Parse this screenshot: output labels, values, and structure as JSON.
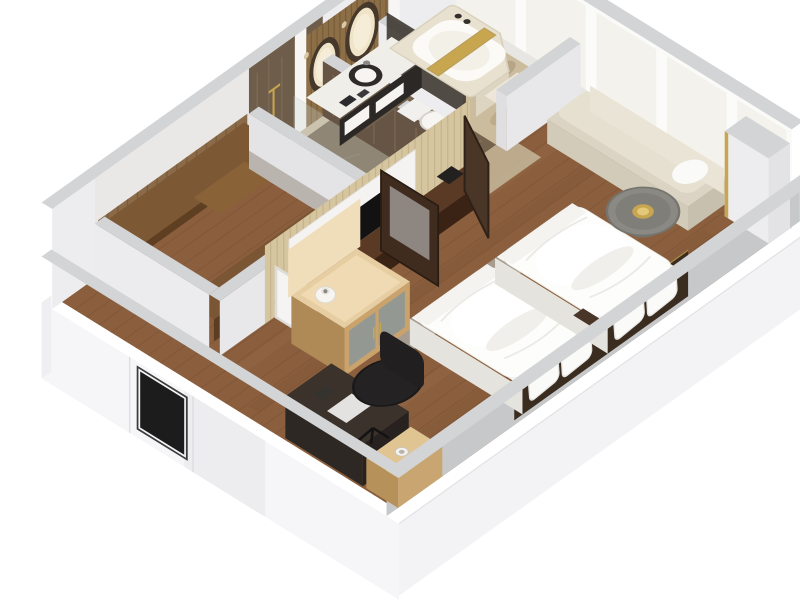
{
  "window": {
    "width": 800,
    "height": 600,
    "background": "#ffffff"
  },
  "scene": {
    "type": "3d-floorplan-cutaway-render",
    "subject": "hotel guest room with twin beds",
    "view": "isometric top-down, rotated, walls cut at height, white background",
    "rooms": [
      {
        "name": "bathroom",
        "floor": "beige marble",
        "objects": [
          "vanity-counter",
          "vessel-sink",
          "oval-mirror-1",
          "oval-mirror-2",
          "gold-slat-wall",
          "bathtub",
          "gold-bath-tray",
          "towels"
        ]
      },
      {
        "name": "shower-room",
        "floor": "dark marble",
        "objects": [
          "shower-bench",
          "glass-screen",
          "shower-fixture"
        ]
      },
      {
        "name": "water-closet",
        "floor": "dark marble",
        "objects": [
          "toilet"
        ]
      },
      {
        "name": "walk-in-closet",
        "floor": "wood",
        "objects": [
          "closet-shelf",
          "hanging-clothes",
          "drawer-unit"
        ]
      },
      {
        "name": "bedroom",
        "floor": "wood planks",
        "objects": [
          "bed-1",
          "bed-2",
          "headboard",
          "mid-nightstand",
          "tv-panel",
          "tv-console",
          "tissue-box",
          "window-daybed",
          "round-table",
          "gold-bowl",
          "desk",
          "desk-chair",
          "low-nightstand",
          "minibar-cabinet",
          "white-vase",
          "gray-runner-rug",
          "open-door-leaf",
          "wardrobe-door-mirror"
        ]
      },
      {
        "name": "entry",
        "objects": [
          "entry-door"
        ]
      }
    ],
    "window_wall": {
      "position": "upper-right",
      "panes": 5,
      "mullions": "white"
    }
  },
  "palette": {
    "background": "#ffffff",
    "wood_floor": "#8b5f3e",
    "wood_plank_line": "#6e4a2c",
    "wood_streak_light": "#a0744e",
    "marble_beige": "#ccbc9e",
    "marble_beige_mottle": "#ae9a76",
    "marble_dark_floor": "#75634e",
    "marble_dark_wall": "#6e5d4a",
    "wall_top": "#d3d4d6",
    "wall_inner": "#ededef",
    "wall_outer": "#f4f4f6",
    "window_glass": "#f4f2ec",
    "bed_white": "#fdfdfb",
    "duvet_shadow": "#e9e8e3",
    "headboard": "#3b2c20",
    "console_wood": "#5a3a24",
    "tv_backing": "#d6c6a0",
    "tv_screen": "#121212",
    "gold_accent": "#c8a54f",
    "gold_slat_wall": "#8d6f47",
    "minibar_wood": "#e7cda2",
    "desk_dark": "#3a322b",
    "chair_black": "#242223",
    "bench_cushion": "#e6e0d1",
    "tub_deck": "#e8e1cf",
    "entry_door": "#1c1c1c",
    "nightstand_wood": "#e0c593",
    "closet_wood": "#8a6a48",
    "rug_gray": "#aba79f"
  }
}
